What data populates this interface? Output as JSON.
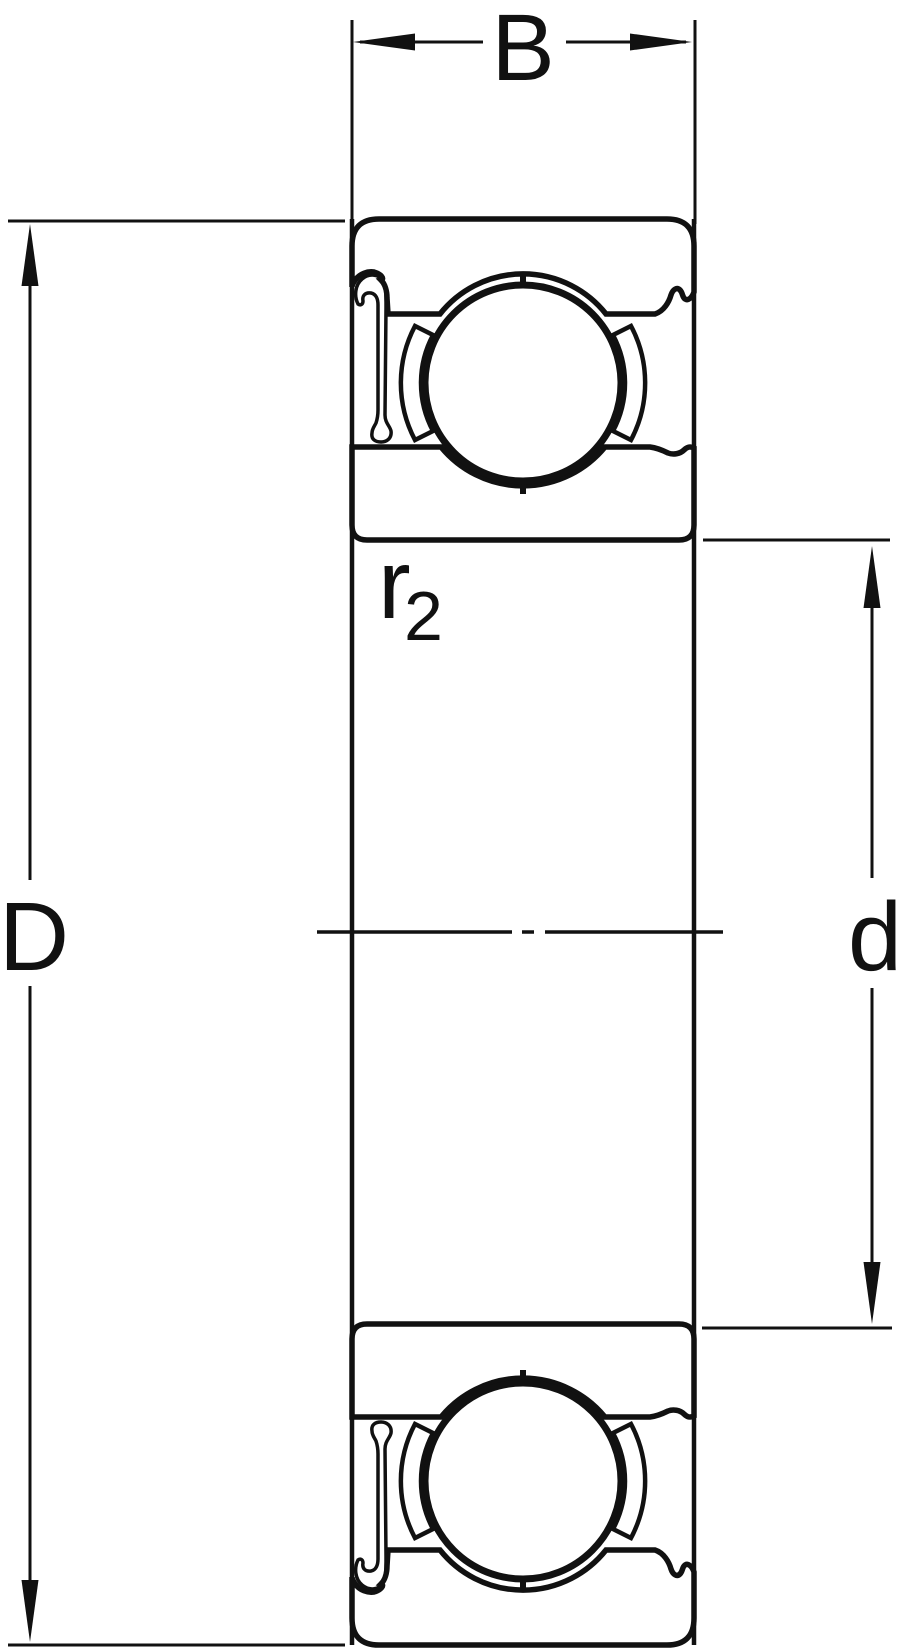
{
  "figure": {
    "title": "deep groove ball bearing cross-section with shield",
    "dimension_labels": {
      "width": "B",
      "outer_diameter": "D",
      "bore_diameter": "d",
      "shoulder_radius": "r",
      "shoulder_radius_subscript": "2"
    },
    "colors": {
      "section_fill": "#c5d3e8",
      "line": "#111111",
      "background": "#ffffff"
    }
  }
}
